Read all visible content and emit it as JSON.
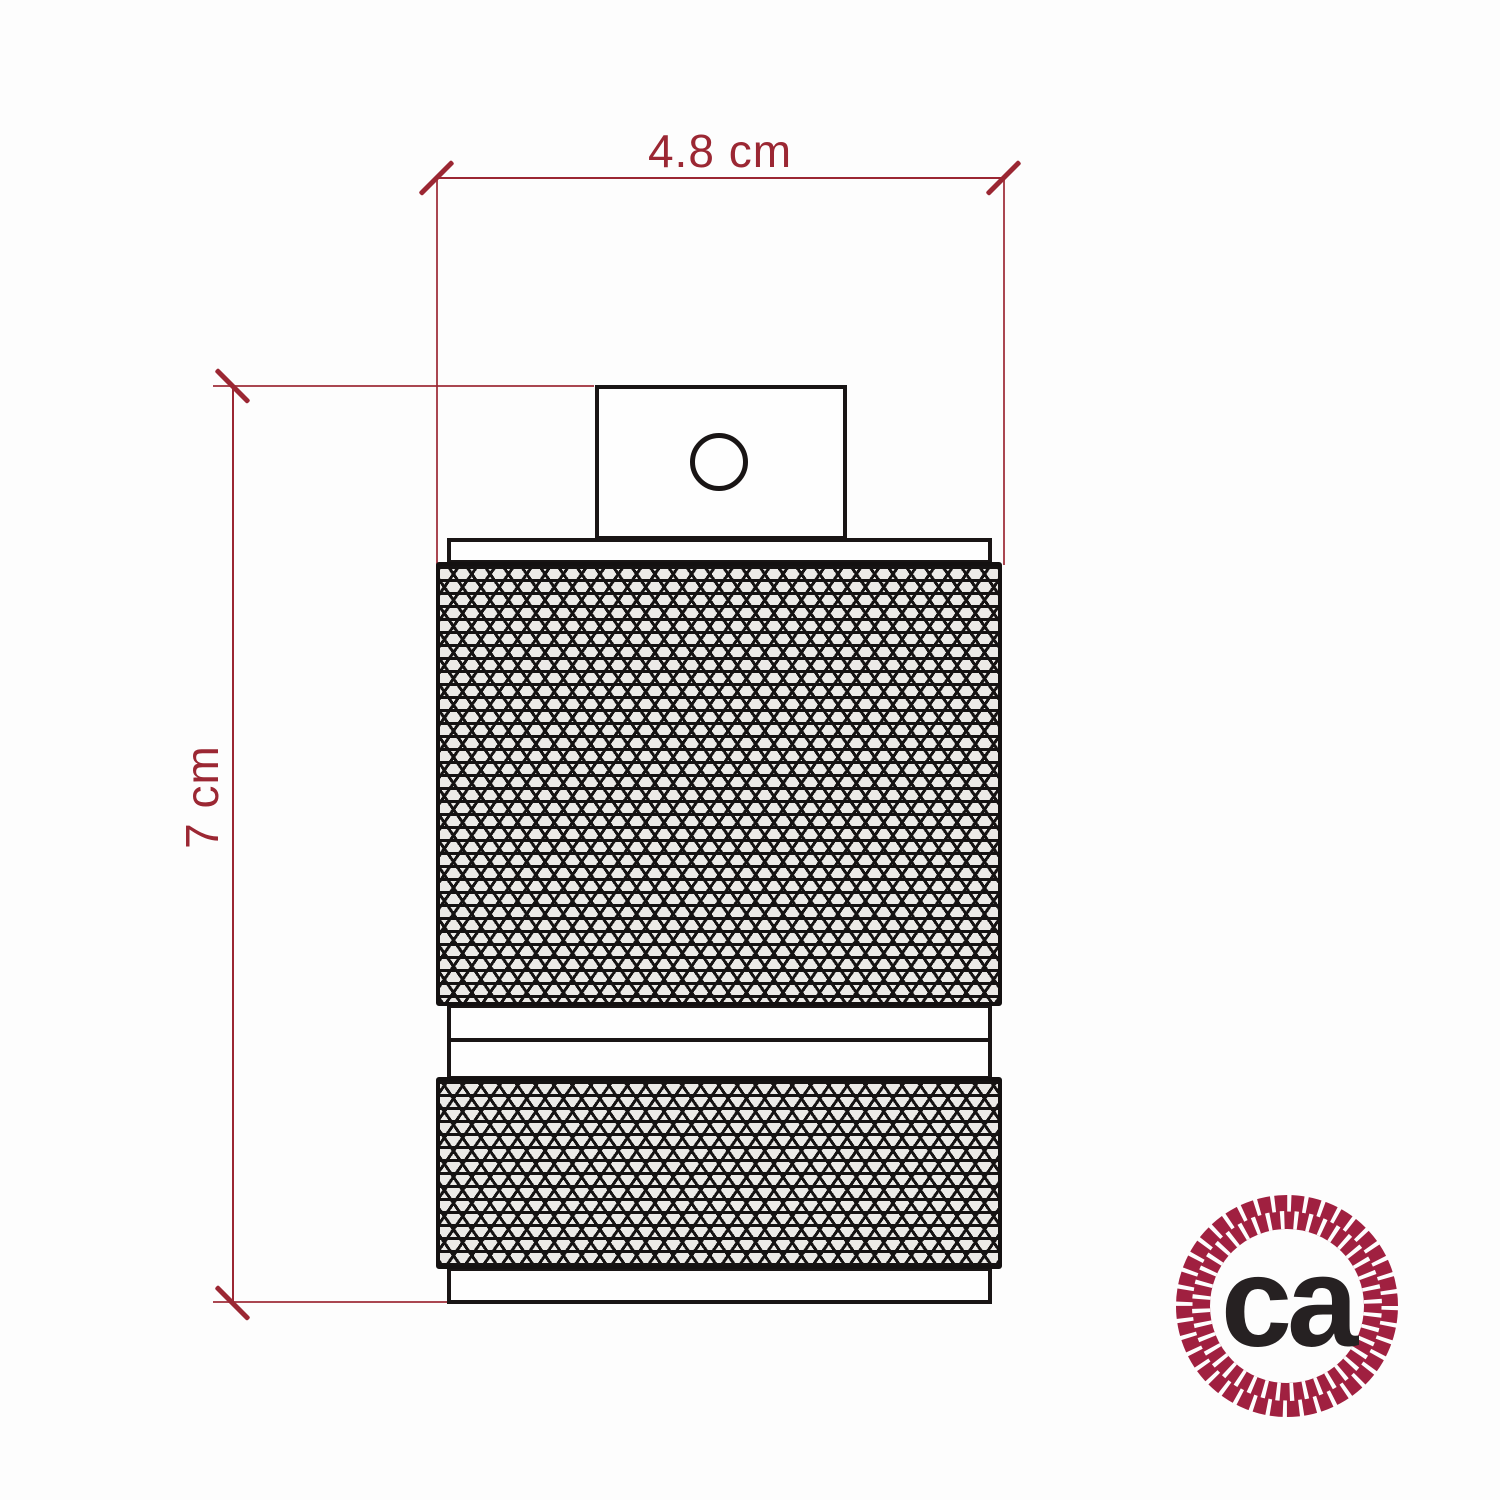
{
  "page": {
    "background_color": "#fdfdfd",
    "type": "technical-dimension-drawing"
  },
  "drawing": {
    "subject_icon": "knurled-lamp-holder-side-view",
    "outline_color": "#191515",
    "knurl_fill_color": "#eceae7"
  },
  "dimensions": {
    "color": "#9b2733",
    "width": {
      "label": "4.8 cm"
    },
    "height": {
      "label": "7 cm"
    }
  },
  "logo": {
    "icon": "rope-circle-logo",
    "text": "ca",
    "ring_color": "#a02040",
    "text_color": "#262122"
  }
}
